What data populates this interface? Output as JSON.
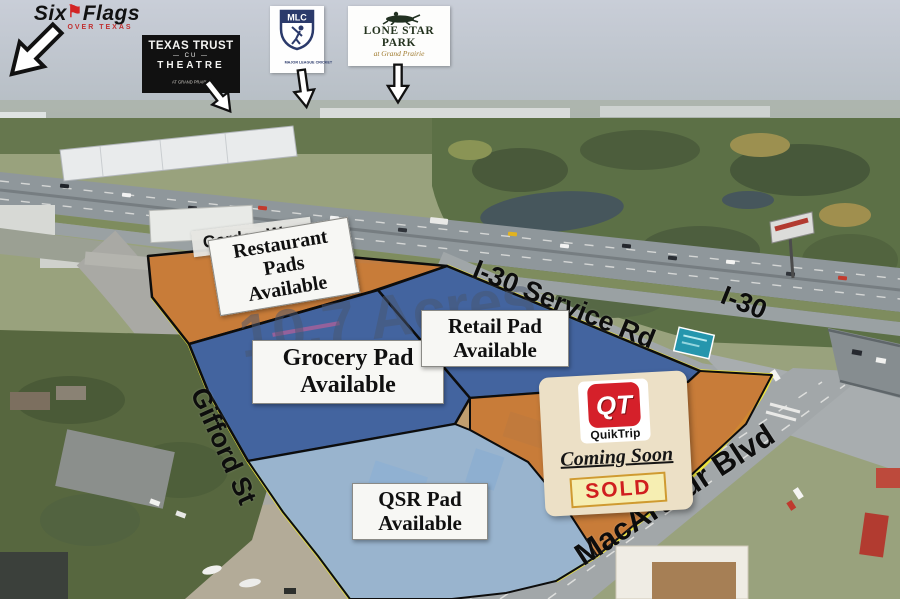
{
  "logos": {
    "six_flags": {
      "word1": "Six",
      "word2": "Flags",
      "flag_icon": "⚑",
      "tagline": "OVER TEXAS"
    },
    "texas_trust": {
      "line1": "TEXAS TRUST",
      "line2": "—  CU  —",
      "line3": "THEATRE",
      "line4": "AT GRAND PRAIRIE"
    },
    "mlc": {
      "abbr": "MLC",
      "name": "MAJOR LEAGUE CRICKET"
    },
    "lone_star": {
      "name": "LONE STAR PARK",
      "tagline": "at Grand Prairie"
    }
  },
  "roads": {
    "garden_way": "Garden Way",
    "i30_service": "I-30 Service Rd",
    "i30": "I-30",
    "gifford": "Gifford St",
    "macarthur": "MacArthur Blvd"
  },
  "watermark": {
    "fragment": "5",
    "acreage": "10.7 Acres"
  },
  "parcels": {
    "restaurant": {
      "label_lines": [
        "Restaurant",
        "Pads",
        "Available"
      ],
      "fill": "#c9762e"
    },
    "grocery": {
      "label_lines": [
        "Grocery Pad",
        "Available"
      ],
      "fill": "#2e5ba8"
    },
    "retail": {
      "label_lines": [
        "Retail Pad",
        "Available"
      ],
      "fill": "#2e5ba8"
    },
    "qsr": {
      "label_lines": [
        "QSR Pad",
        "Available"
      ],
      "fill": "#8fb9e6"
    },
    "quiktrip": {
      "fill": "#c9762e"
    }
  },
  "qt_sign": {
    "abbr": "QT",
    "brand": "QuikTrip",
    "status": "Coming Soon",
    "sold": "SOLD"
  },
  "colors": {
    "boundary_yellow": "#ece43c",
    "boundary_black": "#0d0d0d"
  }
}
